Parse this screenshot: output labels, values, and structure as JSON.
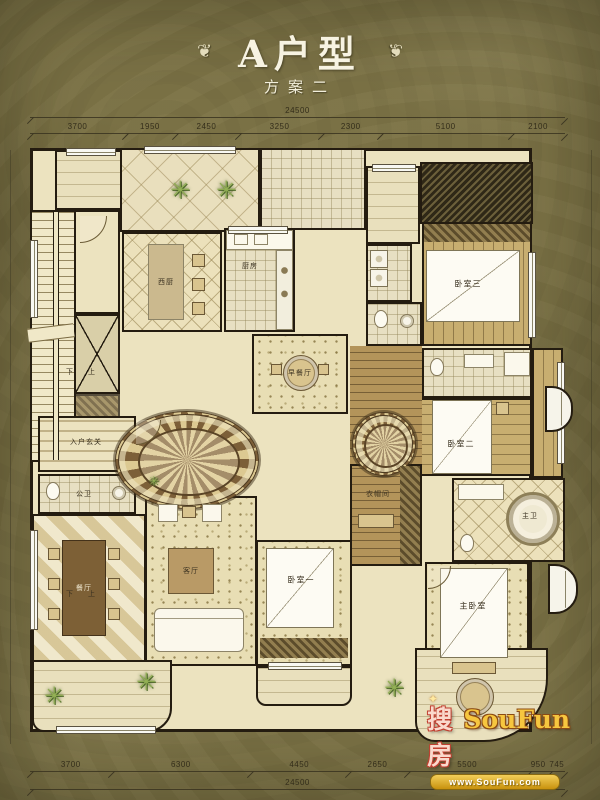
{
  "title": {
    "main": "A户型",
    "sub": "方案二",
    "ornament": "❦"
  },
  "dims": {
    "top_total": "24500",
    "top_segments": [
      "3700",
      "1950",
      "2450",
      "3250",
      "2300",
      "5100",
      "2100"
    ],
    "bottom_segments": [
      "3700",
      "6300",
      "4450",
      "2650",
      "5500",
      "950",
      "745"
    ],
    "bottom_total": "24500"
  },
  "rooms": {
    "entry": "入户玄关",
    "guest_bath": "公卫",
    "west_kitchen": "西厨",
    "kitchen": "厨房",
    "breakfast": "早餐厅",
    "dining": "餐厅",
    "living": "客厅",
    "bedroom1": "卧室一",
    "bedroom2": "卧室二",
    "bedroom3": "卧室三",
    "master_bedroom": "主卧室",
    "master_bath": "主卫",
    "closet": "衣帽间"
  },
  "stairs": {
    "up": "上",
    "down": "下"
  },
  "decor": {
    "plant": "✳",
    "star": "✦"
  },
  "watermark": {
    "cn": "搜房",
    "en": "SouFun",
    "url": "www.SouFun.com"
  },
  "colors": {
    "background": "#7a7145",
    "wall": "#241c10",
    "floor": "#ece3bf",
    "logo_gold": "#f6c63f",
    "logo_red": "#c04030"
  }
}
